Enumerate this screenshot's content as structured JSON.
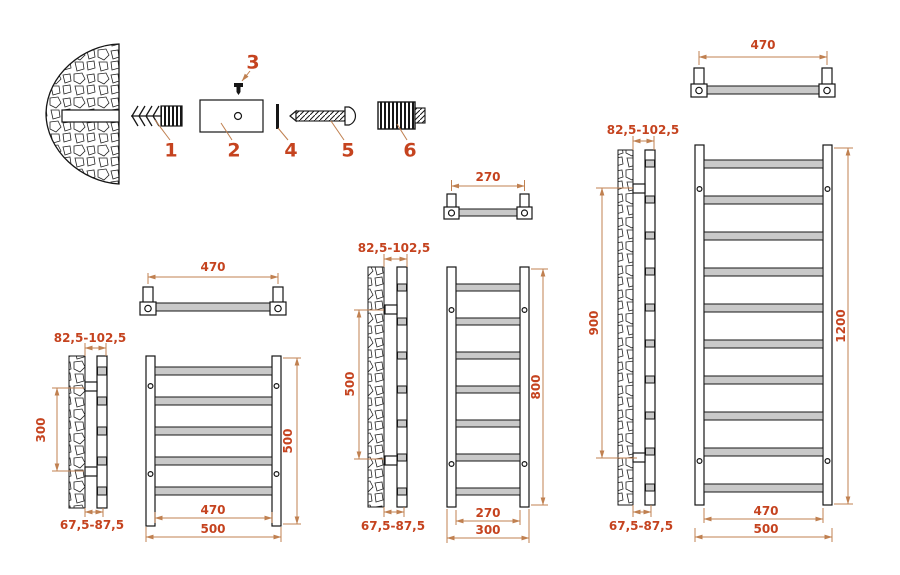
{
  "kit": {
    "part_numbers": [
      "1",
      "2",
      "3",
      "4",
      "5",
      "6"
    ]
  },
  "models": [
    {
      "id": "500x500",
      "top_view_width": "470",
      "wall_offset_top": "82,5-102,5",
      "bracket_span": "300",
      "height": "500",
      "rail_width": "470",
      "overall_width": "500",
      "wall_offset_bottom": "67,5-87,5",
      "rungs": 5
    },
    {
      "id": "800x300",
      "top_view_width": "270",
      "wall_offset_top": "82,5-102,5",
      "bracket_span": "500",
      "height": "800",
      "rail_width": "270",
      "overall_width": "300",
      "wall_offset_bottom": "67,5-87,5",
      "rungs": 7
    },
    {
      "id": "1200x500",
      "top_view_width": "470",
      "wall_offset_top": "82,5-102,5",
      "bracket_span": "900",
      "height": "1200",
      "rail_width": "470",
      "overall_width": "500",
      "wall_offset_bottom": "67,5-87,5",
      "rungs": 10
    }
  ]
}
